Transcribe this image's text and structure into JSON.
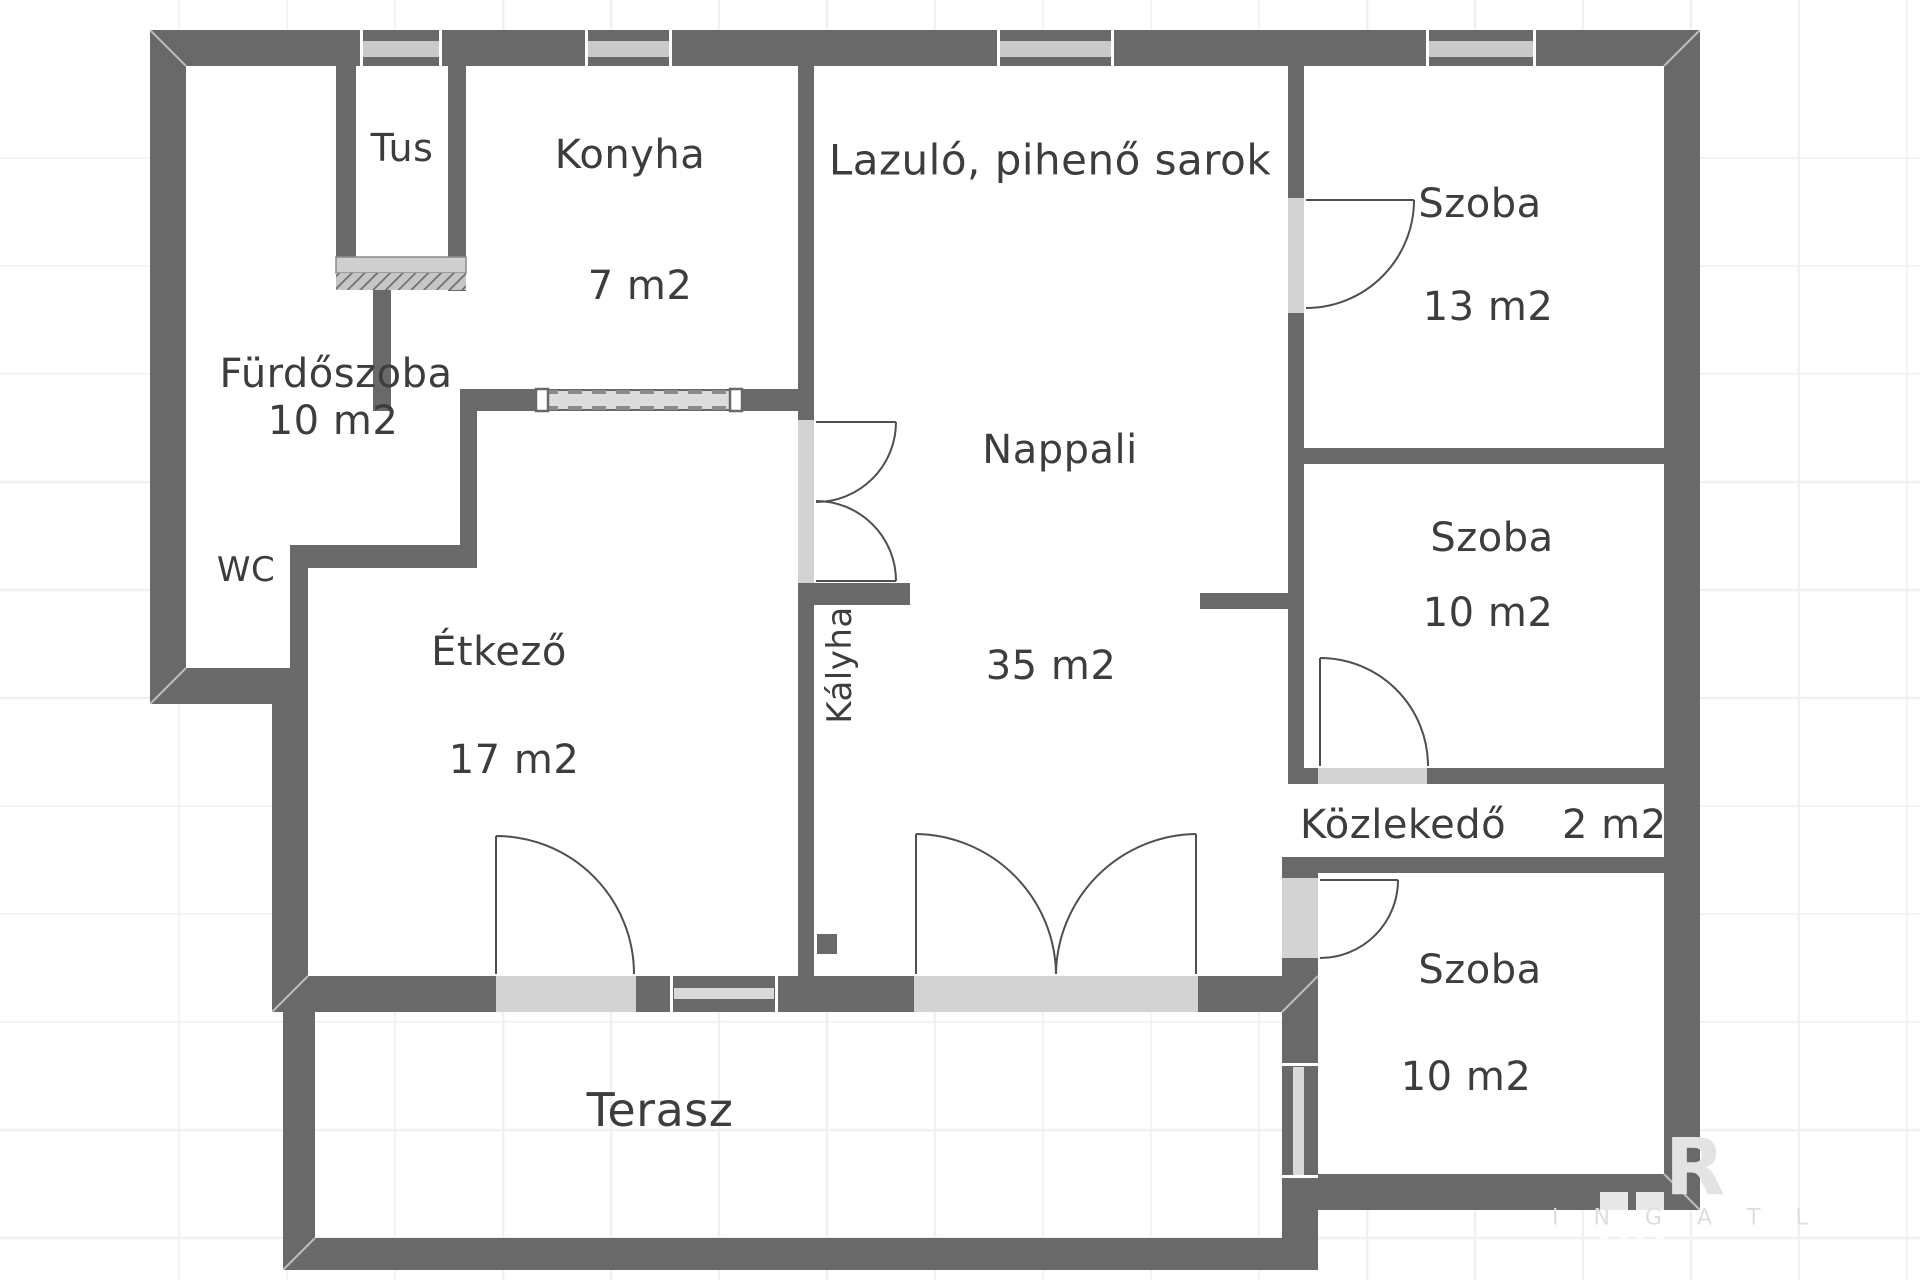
{
  "title": "Floor plan",
  "rooms": {
    "tus": {
      "name": "Tus"
    },
    "konyha": {
      "name": "Konyha",
      "area": "7 m2"
    },
    "lazulo": {
      "name": "Lazuló, pihenő sarok"
    },
    "szoba13": {
      "name": "Szoba",
      "area": "13 m2"
    },
    "furdoszoba": {
      "name": "Fürdőszoba",
      "area": "10 m2"
    },
    "wc": {
      "name": "WC"
    },
    "etkezo": {
      "name": "Étkező",
      "area": "17 m2"
    },
    "nappali": {
      "name": "Nappali",
      "area": "35 m2"
    },
    "kalyha": {
      "name": "Kályha"
    },
    "szoba10a": {
      "name": "Szoba",
      "area": "10 m2"
    },
    "kozlekedo": {
      "name": "Közlekedő",
      "area": "2 m2"
    },
    "szoba10b": {
      "name": "Szoba",
      "area": "10 m2"
    },
    "terasz": {
      "name": "Terasz"
    }
  },
  "watermark": {
    "letter": "R",
    "text": "I N G A T L"
  },
  "colors": {
    "wall": "#696969",
    "opening": "#d3d3d3",
    "window_bar": "#c9c9c9",
    "door_stroke": "#4f4f4f",
    "text": "#3d3d3d",
    "grid": "#f0f0f0"
  }
}
